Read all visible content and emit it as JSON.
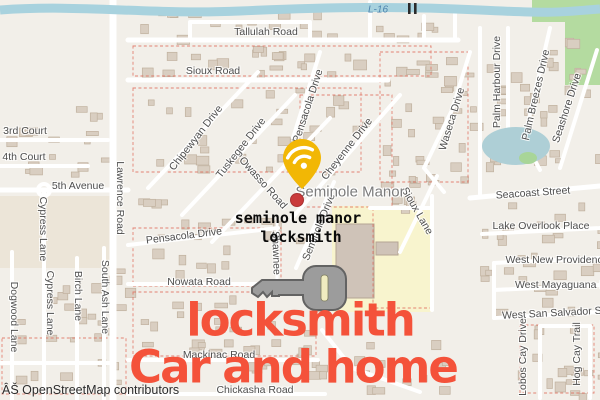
{
  "overlay": {
    "query_line1": "seminole manor",
    "query_line2": "locksmith",
    "headline_line1": "locksmith",
    "headline_line2": "Car and home",
    "headline_color": "#f4523a"
  },
  "attribution": "ÂŠ OpenStreetMap contributors",
  "place_label": "Seminole Manor",
  "water_label": "L-16",
  "marker": {
    "name": "location-pin",
    "color": "#f2b705",
    "glyph": "wifi"
  },
  "icons": [
    "location-pin-icon",
    "wifi-icon",
    "key-icon",
    "water-gate-icon"
  ],
  "street_labels": [
    {
      "t": "Tallulah Road",
      "x": 266,
      "y": 32,
      "r": 0
    },
    {
      "t": "Sioux Road",
      "x": 213,
      "y": 71,
      "r": 0
    },
    {
      "t": "3rd Court",
      "x": 25,
      "y": 131,
      "r": 0
    },
    {
      "t": "4th Court",
      "x": 24,
      "y": 157,
      "r": 0
    },
    {
      "t": "5th Avenue",
      "x": 78,
      "y": 186,
      "r": 0
    },
    {
      "t": "Lawrence Road",
      "x": 120,
      "y": 198,
      "r": 90
    },
    {
      "t": "Cypress Lane",
      "x": 43,
      "y": 229,
      "r": 90
    },
    {
      "t": "Cypress Lane",
      "x": 50,
      "y": 303,
      "r": 90
    },
    {
      "t": "Dogwood Lane",
      "x": 14,
      "y": 317,
      "r": 90
    },
    {
      "t": "Birch Lane",
      "x": 78,
      "y": 296,
      "r": 90
    },
    {
      "t": "South Ash Lane",
      "x": 105,
      "y": 297,
      "r": 90
    },
    {
      "t": "Chipewyan Drive",
      "x": 196,
      "y": 138,
      "r": -52
    },
    {
      "t": "Tuskegee Drive",
      "x": 241,
      "y": 148,
      "r": -52
    },
    {
      "t": "Owasso Road",
      "x": 263,
      "y": 183,
      "r": 48
    },
    {
      "t": "Pensacola Drive",
      "x": 308,
      "y": 106,
      "r": -72
    },
    {
      "t": "Cheyenne Drive",
      "x": 347,
      "y": 149,
      "r": -52
    },
    {
      "t": "Pensacola Drive",
      "x": 184,
      "y": 236,
      "r": -7
    },
    {
      "t": "Nowata Road",
      "x": 199,
      "y": 282,
      "r": 0
    },
    {
      "t": "Shawnee",
      "x": 276,
      "y": 253,
      "r": 88
    },
    {
      "t": "Seminole Drive",
      "x": 319,
      "y": 227,
      "r": -68
    },
    {
      "t": "Sioux Lane",
      "x": 417,
      "y": 211,
      "r": 60
    },
    {
      "t": "Waseca Drive",
      "x": 452,
      "y": 119,
      "r": -73
    },
    {
      "t": "Palm Harbour Drive",
      "x": 497,
      "y": 82,
      "r": -90
    },
    {
      "t": "Palm Breezes Drive",
      "x": 536,
      "y": 95,
      "r": -77
    },
    {
      "t": "Seashore Drive",
      "x": 567,
      "y": 108,
      "r": -72
    },
    {
      "t": "Seacoast Street",
      "x": 533,
      "y": 193,
      "r": -4
    },
    {
      "t": "Lake Overlook Place",
      "x": 541,
      "y": 226,
      "r": 0
    },
    {
      "t": "West New Providence",
      "x": 557,
      "y": 260,
      "r": 0
    },
    {
      "t": "West Mayaguana La",
      "x": 563,
      "y": 285,
      "r": 0
    },
    {
      "t": "West San Salvador Stre",
      "x": 558,
      "y": 313,
      "r": -3
    },
    {
      "t": "Lobos Cay Drive",
      "x": 523,
      "y": 357,
      "r": -90
    },
    {
      "t": "Hog Cay Trail",
      "x": 577,
      "y": 354,
      "r": -90
    },
    {
      "t": "Mackinac Road",
      "x": 219,
      "y": 355,
      "r": 0
    },
    {
      "t": "Chickasha Road",
      "x": 255,
      "y": 390,
      "r": 0
    }
  ]
}
